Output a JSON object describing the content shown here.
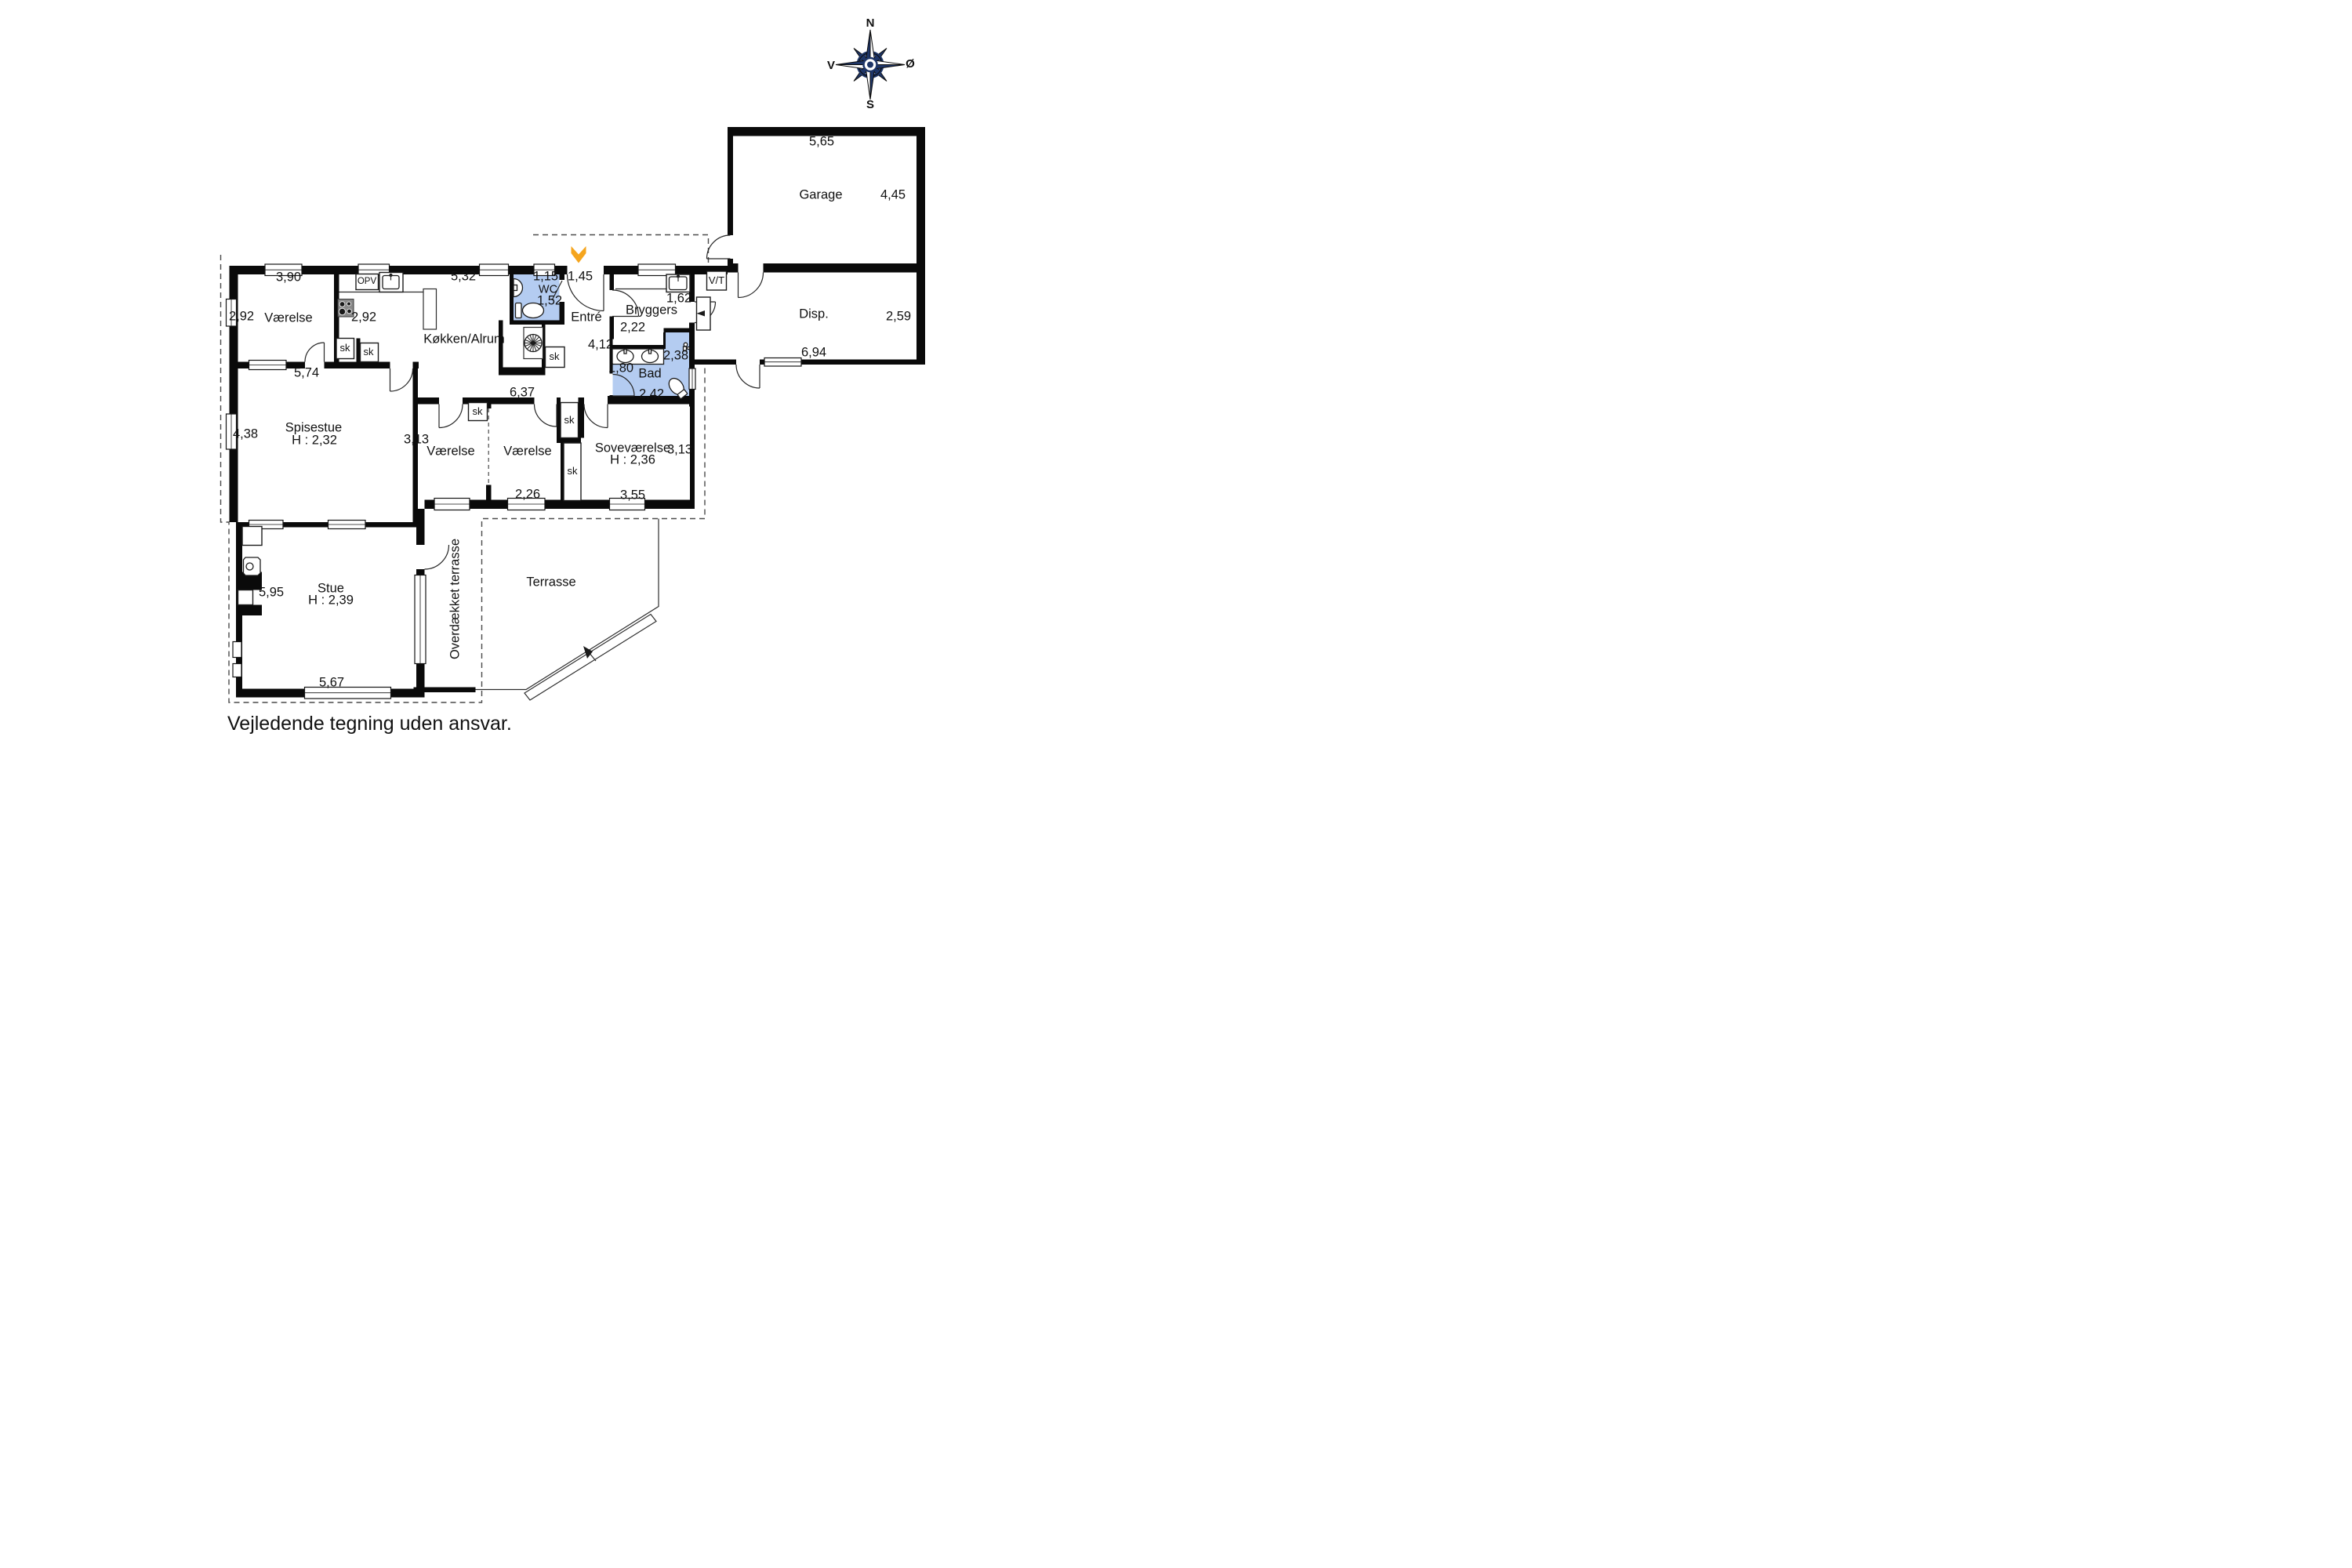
{
  "colors": {
    "wall": "#0a0a0a",
    "wet": "#b4ccf1",
    "accent": "#f5a51d",
    "navy": "#1e3567",
    "ink": "#111111"
  },
  "compass": {
    "north": "N",
    "south": "S",
    "east": "Ø",
    "west": "V"
  },
  "labels": {
    "garage": "Garage",
    "garage_w": "5,65",
    "garage_d": "4,45",
    "disp": "Disp.",
    "disp_d": "2,59",
    "disp_w": "6,94",
    "vt": "V/T",
    "bryggers": "Bryggers",
    "bryggers_d1": "1,62",
    "bryggers_d2": "2,22",
    "bad": "Bad",
    "bad_d1": "1,80",
    "bad_d2": "2,42",
    "bad_d3": "2,38",
    "wc": "WC",
    "wc_d1": "1,15",
    "wc_d2": "1,52",
    "entre": "Entré",
    "entre_d1": "1,45",
    "entre_d2": "4,12",
    "kokken": "Køkken/Alrum",
    "kokken_d1": "5,32",
    "kokken_d2": "2,92",
    "kokken_d3": "6,37",
    "varelse_nw": "Værelse",
    "varelse_nw_d1": "3,90",
    "varelse_nw_d2": "2,92",
    "varelse_nw_d3": "5,74",
    "spisestue": "Spisestue",
    "spisestue_h": "H : 2,32",
    "spisestue_d": "4,38",
    "varelse_mid": "Værelse",
    "varelse_mid_d": "3,13",
    "varelse_e": "Værelse",
    "varelse_e_d": "2,26",
    "sove": "Soveværelse",
    "sove_h": "H : 2,36",
    "sove_d1": "3,13",
    "sove_d2": "3,55",
    "stue": "Stue",
    "stue_h": "H : 2,39",
    "stue_d1": "5,95",
    "stue_d2": "5,67",
    "terrasse": "Terrasse",
    "overdaekket": "Overdækket terrasse",
    "opv": "OPV",
    "sk": "sk",
    "footer": "Vejledende tegning uden ansvar."
  }
}
